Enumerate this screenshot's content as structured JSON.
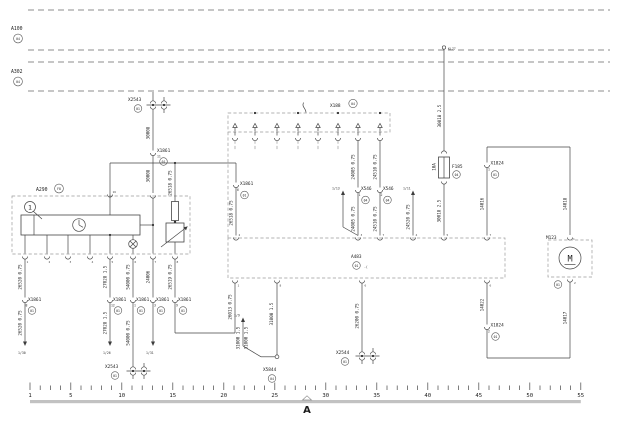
{
  "buses": {
    "a100": "A100",
    "a100_ref": "04",
    "a302": "A302",
    "a302_ref": "04"
  },
  "power": {
    "terminal": "KL77",
    "fuse": "F185",
    "fuse_rating": "10A",
    "fuse_ref": "04"
  },
  "components": {
    "a290": "A290",
    "a290_ref": "F8",
    "a290_callout": "1",
    "a290_pin16": "16",
    "a483": "A483",
    "a483_ref": "01",
    "a483_sym": "-(",
    "x188": "X188",
    "x188_ref": "04",
    "m123": "M123",
    "m123_ref": "01",
    "m123_letter": "M",
    "m123_pin1": "1",
    "m123_pin2": "2"
  },
  "connectors": {
    "x1861": "X1861",
    "x1861_ref": "01",
    "pin11": "11",
    "pin6": "6",
    "pin8": "8",
    "pin12": "12",
    "pin1": "1",
    "pin3": "3",
    "pin9": "9",
    "x2543": "X2543",
    "x2543_ref": "01",
    "x2544": "X2544",
    "x2544_ref": "01",
    "x5844": "X5844",
    "x5844_ref": "04",
    "x546": "X546",
    "x546_ref": "04",
    "x546_pin1": "1",
    "x546_pin2": "2",
    "x1824": "X1824",
    "x1824_ref": "01",
    "x1824_pin1": "1",
    "x1824_pin2": "2"
  },
  "wires": {
    "w30018": "30018 2.5",
    "w30008": "30008",
    "w26518": "26518 0.75",
    "w26520": "26520 0.75",
    "w27028": "27028 1.5",
    "w54000": "54000 0.75",
    "w24006": "24006",
    "w26519": "26519 0.75",
    "w26013": "26013 0.75",
    "w24005": "24005 0.75",
    "w24510": "24510 0.75",
    "w24520": "24520 0.75",
    "w26200": "26200 0.75",
    "w31000": "31000 1.5",
    "w14016": "14016",
    "w14018": "14018",
    "w14022": "14022",
    "w14017": "14017"
  },
  "page_refs": {
    "r130": "1/30",
    "r126": "1/26",
    "r131": "1/31",
    "r19": "1/9",
    "r113": "1/13",
    "r111": "1/11"
  },
  "pins": {
    "a483_top": [
      "2",
      "3",
      "7",
      "4",
      "5",
      "7"
    ],
    "a483_bottom": [
      "1",
      "8",
      "6",
      "6"
    ],
    "a290_bottom": [
      "1",
      "2",
      "3",
      "4",
      "5",
      "6",
      "7",
      "8"
    ]
  },
  "ruler": {
    "numbers": [
      "1",
      "5",
      "10",
      "15",
      "20",
      "25",
      "30",
      "35",
      "40",
      "45",
      "50",
      "55"
    ],
    "section": "A"
  }
}
